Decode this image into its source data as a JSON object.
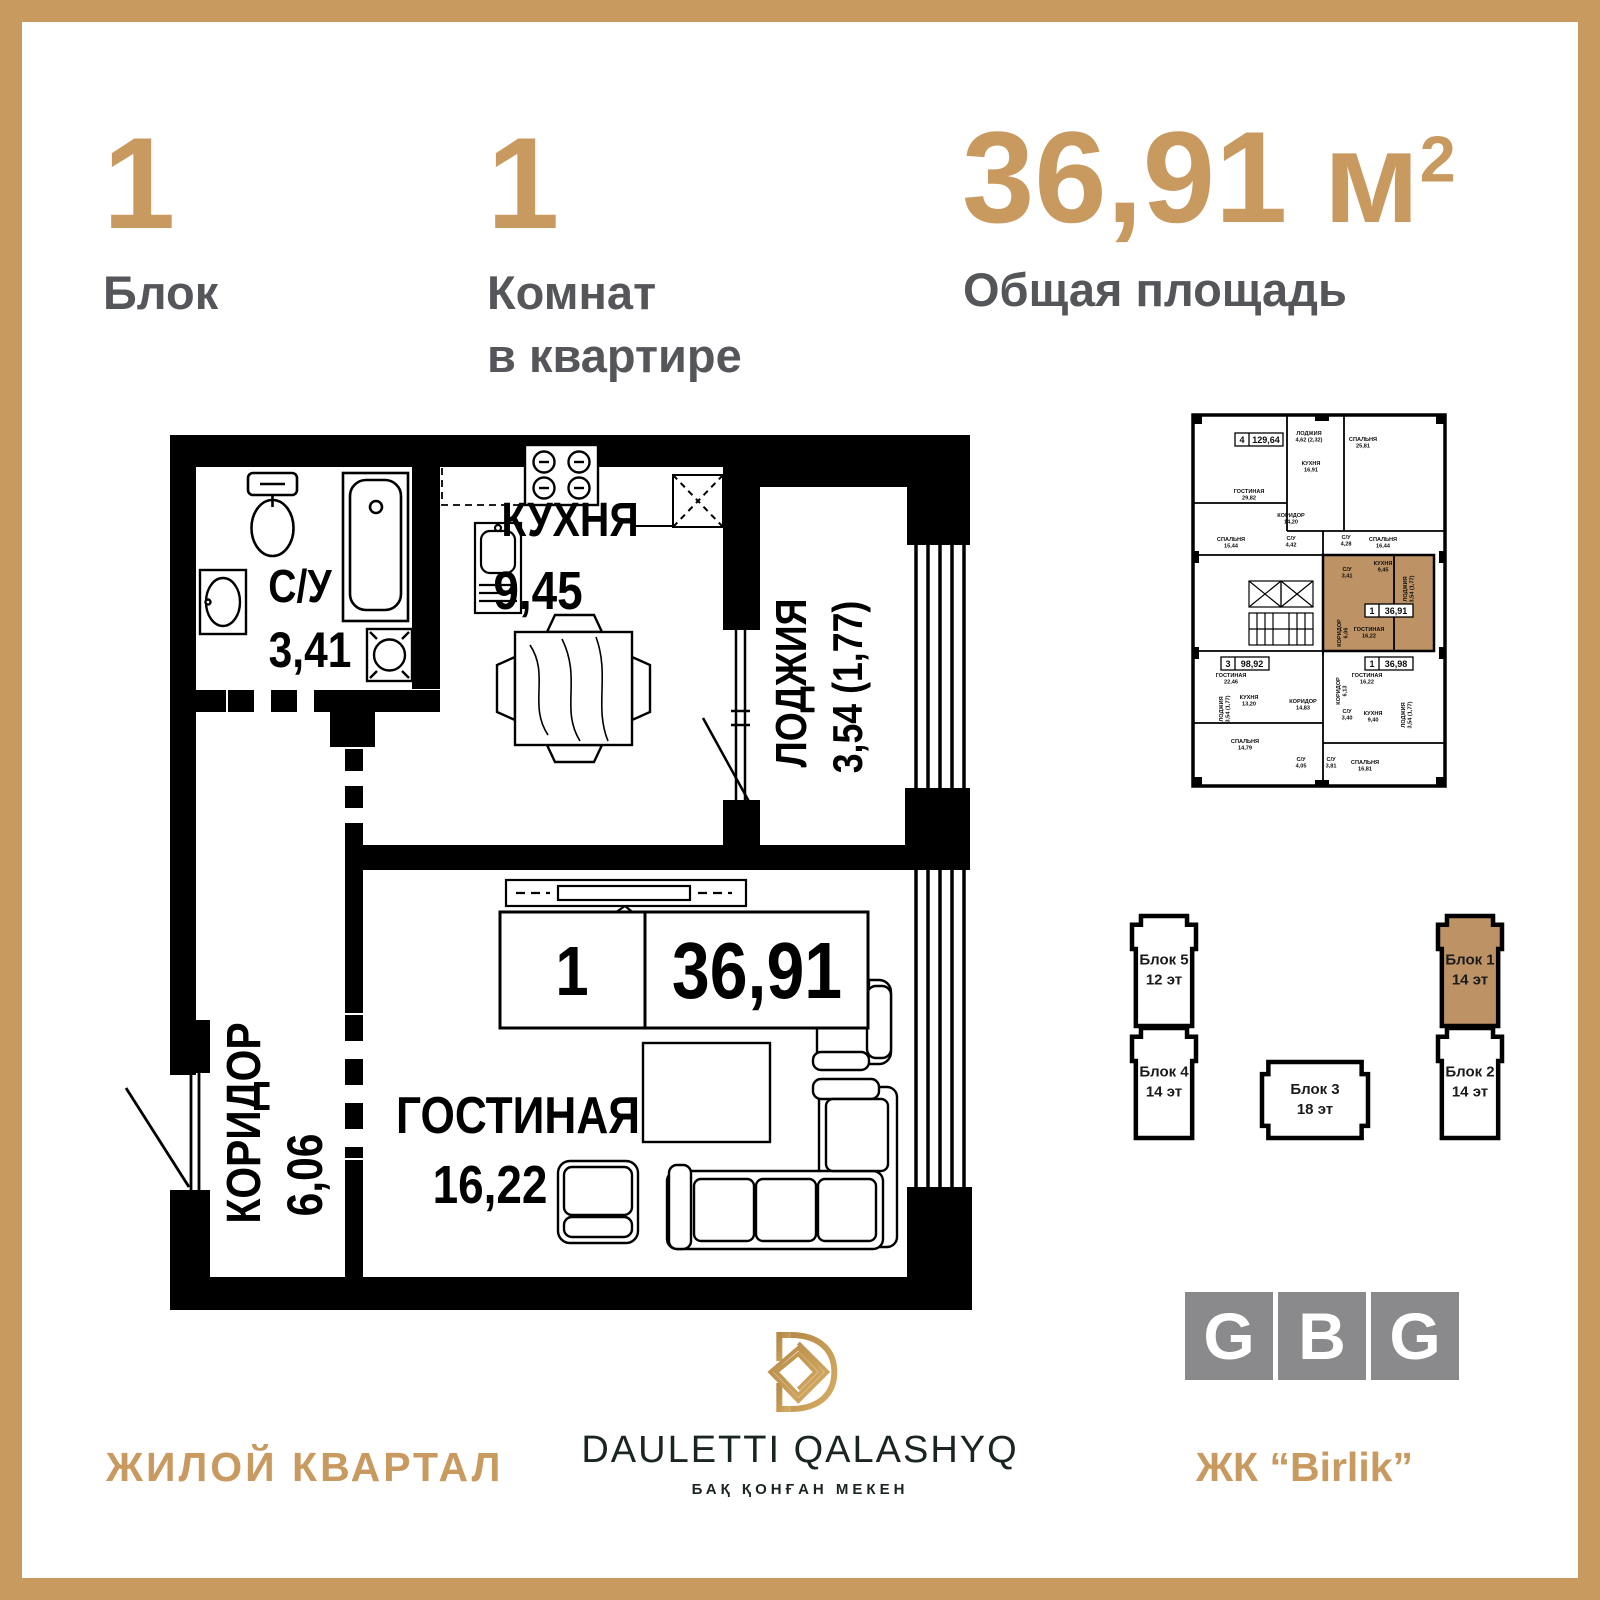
{
  "meta": {
    "background": "#ffffff",
    "gold_accent": "#c89a60",
    "dark_text": "#55565a",
    "tan_highlight": "#bd9365",
    "logo_gray": "#8a8a8d",
    "wall_black": "#000000"
  },
  "header": {
    "block_number": "1",
    "block_label": "Блок",
    "rooms_number": "1",
    "rooms_label_line1": "Комнат",
    "rooms_label_line2": "в квартире",
    "area_value": "36,91 м",
    "area_sup": "2",
    "area_label": "Общая площадь"
  },
  "plan": {
    "unit_number": "1",
    "unit_area": "36,91",
    "rooms": {
      "bathroom": {
        "name": "С/У",
        "area": "3,41"
      },
      "kitchen": {
        "name": "КУХНЯ",
        "area": "9,45"
      },
      "loggia": {
        "name": "ЛОДЖИЯ",
        "area": "3,54 (1,77)"
      },
      "corridor": {
        "name": "КОРИДОР",
        "area": "6,06"
      },
      "living": {
        "name": "ГОСТИНАЯ",
        "area": "16,22"
      }
    }
  },
  "mini_plan": {
    "unit_boxes": [
      {
        "num": "4",
        "area": "129,64",
        "x": 44,
        "y": 20
      },
      {
        "num": "3",
        "area": "98,92",
        "x": 30,
        "y": 244
      },
      {
        "num": "1",
        "area": "36,91",
        "x": 174,
        "y": 191
      },
      {
        "num": "1",
        "area": "36,98",
        "x": 174,
        "y": 244
      }
    ],
    "labels": [
      {
        "t": "ГОСТИНАЯ",
        "a": "29,82",
        "x": 58,
        "y": 80
      },
      {
        "t": "ЛОДЖИЯ",
        "a": "4,62 (2,32)",
        "x": 118,
        "y": 22
      },
      {
        "t": "СПАЛЬНЯ",
        "a": "25,81",
        "x": 172,
        "y": 28
      },
      {
        "t": "КУХНЯ",
        "a": "16,91",
        "x": 120,
        "y": 52
      },
      {
        "t": "КОРИДОР",
        "a": "14,20",
        "x": 100,
        "y": 104
      },
      {
        "t": "СПАЛЬНЯ",
        "a": "15,44",
        "x": 40,
        "y": 128
      },
      {
        "t": "С/У",
        "a": "4,42",
        "x": 100,
        "y": 127
      },
      {
        "t": "С/У",
        "a": "4,28",
        "x": 155,
        "y": 126
      },
      {
        "t": "СПАЛЬНЯ",
        "a": "16,44",
        "x": 192,
        "y": 128
      },
      {
        "t": "С/У",
        "a": "3,41",
        "x": 156,
        "y": 158
      },
      {
        "t": "КУХНЯ",
        "a": "9,45",
        "x": 192,
        "y": 152
      },
      {
        "t": "ЛОДЖИЯ",
        "a": "3,54 (1,77)",
        "x": 216,
        "y": 176,
        "r": -90
      },
      {
        "t": "КОРИДОР",
        "a": "6,06",
        "x": 150,
        "y": 220,
        "r": -90
      },
      {
        "t": "ГОСТИНАЯ",
        "a": "16,22",
        "x": 178,
        "y": 218
      },
      {
        "t": "ГОСТИНАЯ",
        "a": "22,46",
        "x": 40,
        "y": 264
      },
      {
        "t": "ГОСТИНАЯ",
        "a": "16,22",
        "x": 176,
        "y": 264
      },
      {
        "t": "КУХНЯ",
        "a": "13,20",
        "x": 58,
        "y": 286
      },
      {
        "t": "КОРИДОР",
        "a": "14,83",
        "x": 112,
        "y": 290
      },
      {
        "t": "КОРИДОР",
        "a": "6,13",
        "x": 149,
        "y": 278,
        "r": -90
      },
      {
        "t": "С/У",
        "a": "3,40",
        "x": 156,
        "y": 300
      },
      {
        "t": "КУХНЯ",
        "a": "9,40",
        "x": 182,
        "y": 302
      },
      {
        "t": "ЛОДЖИЯ",
        "a": "3,54 (1,77)",
        "x": 214,
        "y": 302,
        "r": -90
      },
      {
        "t": "ЛОДЖИЯ",
        "a": "3,54 (1,77)",
        "x": 32,
        "y": 296,
        "r": -90
      },
      {
        "t": "СПАЛЬНЯ",
        "a": "14,79",
        "x": 54,
        "y": 330
      },
      {
        "t": "С/У",
        "a": "4,05",
        "x": 110,
        "y": 348
      },
      {
        "t": "С/У",
        "a": "3,81",
        "x": 140,
        "y": 348
      },
      {
        "t": "СПАЛЬНЯ",
        "a": "16,81",
        "x": 174,
        "y": 351
      }
    ]
  },
  "blocks": [
    {
      "label": "Блок 5",
      "floors": "12 эт",
      "x": 32,
      "y": 12,
      "w": 64,
      "h": 110,
      "dir": "v",
      "highlight": false
    },
    {
      "label": "Блок 4",
      "floors": "14 эт",
      "x": 32,
      "y": 124,
      "w": 64,
      "h": 110,
      "dir": "v",
      "highlight": false
    },
    {
      "label": "Блок 3",
      "floors": "18 эт",
      "x": 162,
      "y": 158,
      "w": 106,
      "h": 76,
      "dir": "h",
      "highlight": false
    },
    {
      "label": "Блок 1",
      "floors": "14 эт",
      "x": 338,
      "y": 12,
      "w": 64,
      "h": 110,
      "dir": "v",
      "highlight": true
    },
    {
      "label": "Блок 2",
      "floors": "14 эт",
      "x": 338,
      "y": 124,
      "w": 64,
      "h": 110,
      "dir": "v",
      "highlight": false
    }
  ],
  "footer": {
    "left_label": "ЖИЛОЙ КВАРТАЛ",
    "brand_name": "DAULETTI QALASHYQ",
    "brand_sub": "БАҚ ҚОНҒАН МЕКЕН",
    "right_label": "ЖК “Birlik”",
    "gbg": [
      "G",
      "B",
      "G"
    ]
  }
}
